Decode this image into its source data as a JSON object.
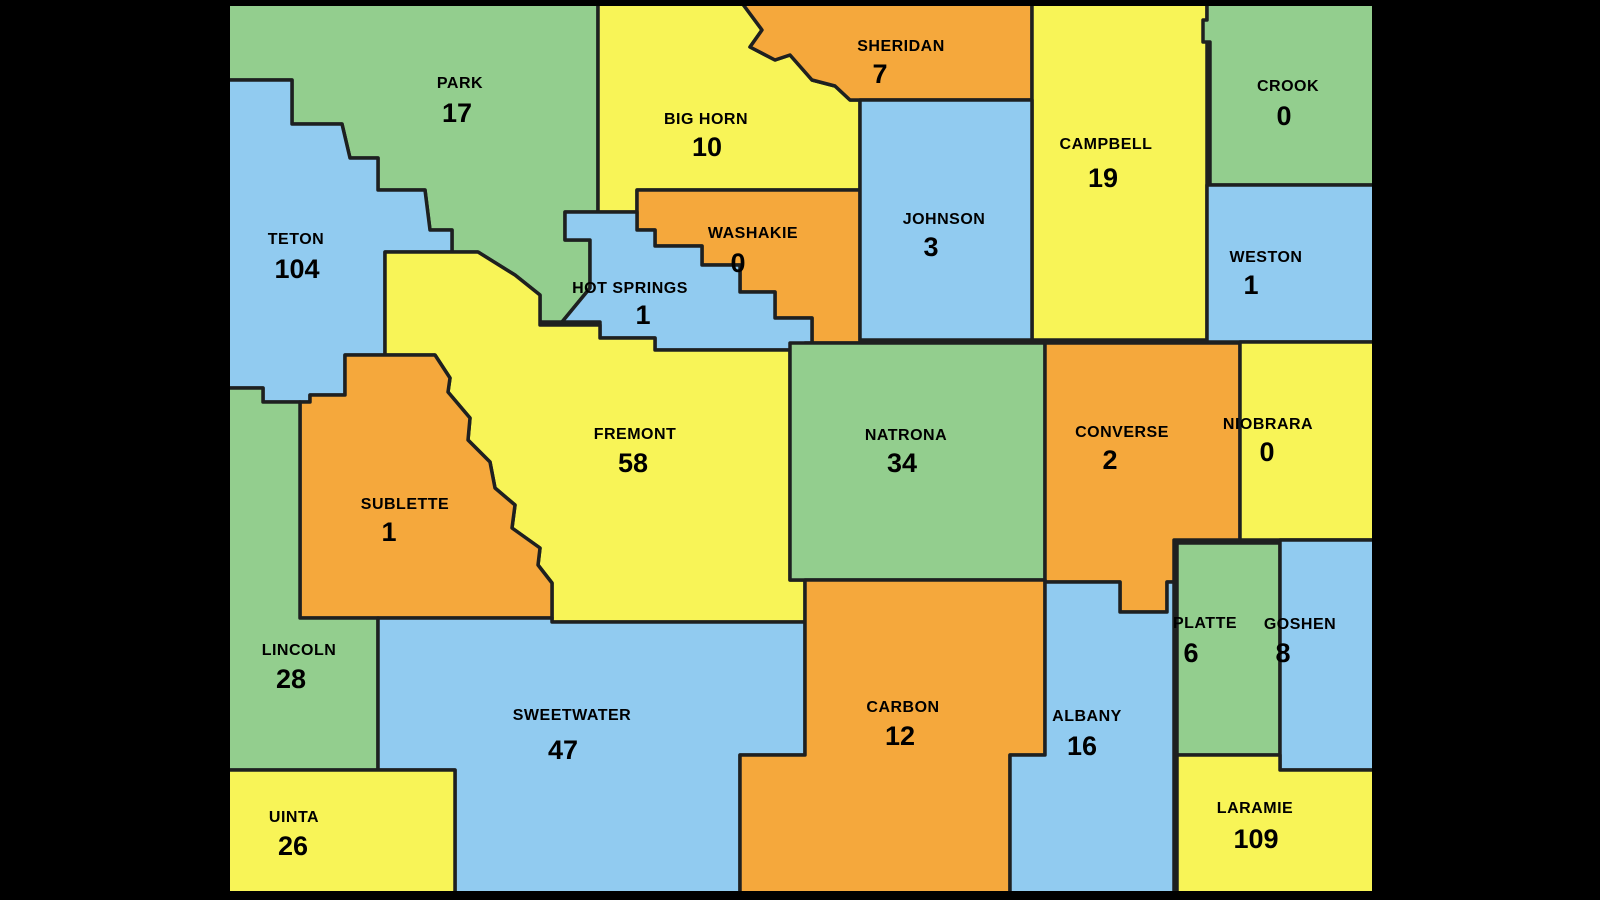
{
  "map": {
    "description": "Wyoming county map with per-county counts",
    "background_color": "#000000",
    "county_border_color": "#1e2020",
    "state_border_color": "#000000",
    "label_color": "#000000",
    "palette": {
      "green": "#93ce8e",
      "yellow": "#f8f457",
      "orange": "#f5a83c",
      "blue": "#91cbf0"
    },
    "state_bounds": {
      "x": 227,
      "y": 3,
      "width": 1148,
      "height": 891
    },
    "counties": [
      {
        "id": "park",
        "name": "PARK",
        "value": "17",
        "color": "green",
        "label": {
          "x": 460,
          "y": 88
        },
        "value_pos": {
          "x": 457,
          "y": 122
        },
        "points": "227,3 598,3 598,212 565,212 565,240 590,240 590,288 562,322 540,322 540,295 515,275 478,252 452,252 452,230 430,230 425,190 378,190 378,158 350,158 342,124 292,124 292,80 227,80"
      },
      {
        "id": "big-horn",
        "name": "BIG HORN",
        "value": "10",
        "color": "yellow",
        "label": {
          "x": 706,
          "y": 124
        },
        "value_pos": {
          "x": 707,
          "y": 156
        },
        "points": "598,3 742,3 762,30 750,47 775,60 790,55 812,80 835,86 850,100 860,100 860,190 637,190 637,212 598,212"
      },
      {
        "id": "sheridan",
        "name": "SHERIDAN",
        "value": "7",
        "color": "orange",
        "label": {
          "x": 901,
          "y": 51
        },
        "value_pos": {
          "x": 880,
          "y": 83
        },
        "points": "742,3 1032,3 1032,100 850,100 835,86 812,80 790,55 775,60 750,47 762,30"
      },
      {
        "id": "campbell",
        "name": "CAMPBELL",
        "value": "19",
        "color": "yellow",
        "label": {
          "x": 1106,
          "y": 149
        },
        "value_pos": {
          "x": 1103,
          "y": 187
        },
        "points": "1032,3 1207,3 1207,340 1032,340"
      },
      {
        "id": "crook",
        "name": "CROOK",
        "value": "0",
        "color": "green",
        "label": {
          "x": 1288,
          "y": 91
        },
        "value_pos": {
          "x": 1284,
          "y": 125
        },
        "points": "1207,3 1374,3 1374,185 1210,185 1210,42 1203,42 1203,20 1207,20"
      },
      {
        "id": "teton",
        "name": "TETON",
        "value": "104",
        "color": "blue",
        "label": {
          "x": 296,
          "y": 244
        },
        "value_pos": {
          "x": 297,
          "y": 278
        },
        "points": "227,80 292,80 292,124 342,124 350,158 378,158 378,190 425,190 430,230 452,230 452,252 385,252 385,355 345,355 345,395 310,395 310,402 263,402 263,388 227,388"
      },
      {
        "id": "washakie",
        "name": "WASHAKIE",
        "value": "0",
        "color": "orange",
        "label": {
          "x": 753,
          "y": 238
        },
        "value_pos": {
          "x": 738,
          "y": 272
        },
        "points": "637,190 860,190 860,343 812,343 812,318 775,318 775,292 740,292 740,265 702,265 702,246 655,246 655,230 637,230"
      },
      {
        "id": "johnson",
        "name": "JOHNSON",
        "value": "3",
        "color": "blue",
        "label": {
          "x": 944,
          "y": 224
        },
        "value_pos": {
          "x": 931,
          "y": 256
        },
        "points": "860,100 1032,100 1032,340 860,340"
      },
      {
        "id": "weston",
        "name": "WESTON",
        "value": "1",
        "color": "blue",
        "label": {
          "x": 1266,
          "y": 262
        },
        "value_pos": {
          "x": 1251,
          "y": 294
        },
        "points": "1207,185 1374,185 1374,342 1207,342"
      },
      {
        "id": "hot-springs",
        "name": "HOT SPRINGS",
        "value": "1",
        "color": "blue",
        "label": {
          "x": 630,
          "y": 293
        },
        "value_pos": {
          "x": 643,
          "y": 324
        },
        "points": "598,212 637,212 637,230 655,230 655,246 702,246 702,265 740,265 740,292 775,292 775,318 812,318 812,343 805,343 805,350 655,350 655,338 600,338 600,322 562,322 590,288 590,240 565,240 565,212"
      },
      {
        "id": "fremont",
        "name": "FREMONT",
        "value": "58",
        "color": "yellow",
        "label": {
          "x": 635,
          "y": 439
        },
        "value_pos": {
          "x": 633,
          "y": 472
        },
        "points": "385,252 452,252 478,252 515,275 540,295 540,325 600,325 600,338 655,338 655,350 790,350 790,580 805,580 805,622 552,622 552,583 538,565 540,548 512,528 515,505 495,488 490,462 468,440 470,418 448,392 450,378 435,355 385,355"
      },
      {
        "id": "natrona",
        "name": "NATRONA",
        "value": "34",
        "color": "green",
        "label": {
          "x": 906,
          "y": 440
        },
        "value_pos": {
          "x": 902,
          "y": 472
        },
        "points": "790,343 1045,343 1045,580 790,580"
      },
      {
        "id": "converse",
        "name": "CONVERSE",
        "value": "2",
        "color": "orange",
        "label": {
          "x": 1122,
          "y": 437
        },
        "value_pos": {
          "x": 1110,
          "y": 469
        },
        "points": "1045,343 1240,343 1240,540 1174,540 1174,582 1167,582 1167,612 1120,612 1120,582 1045,582"
      },
      {
        "id": "niobrara",
        "name": "NIOBRARA",
        "value": "0",
        "color": "yellow",
        "label": {
          "x": 1268,
          "y": 429
        },
        "value_pos": {
          "x": 1267,
          "y": 461
        },
        "points": "1240,342 1374,342 1374,540 1240,540"
      },
      {
        "id": "sublette",
        "name": "SUBLETTE",
        "value": "1",
        "color": "orange",
        "label": {
          "x": 405,
          "y": 509
        },
        "value_pos": {
          "x": 389,
          "y": 541
        },
        "points": "300,402 310,402 310,395 345,395 345,355 435,355 450,378 448,392 470,418 468,440 490,462 495,488 515,505 512,528 540,548 538,565 552,583 552,618 300,618"
      },
      {
        "id": "lincoln",
        "name": "LINCOLN",
        "value": "28",
        "color": "green",
        "label": {
          "x": 299,
          "y": 655
        },
        "value_pos": {
          "x": 291,
          "y": 688
        },
        "points": "227,388 263,388 263,402 300,402 300,618 378,618 378,770 227,770"
      },
      {
        "id": "sweetwater",
        "name": "SWEETWATER",
        "value": "47",
        "color": "blue",
        "label": {
          "x": 572,
          "y": 720
        },
        "value_pos": {
          "x": 563,
          "y": 759
        },
        "points": "378,618 552,618 552,622 805,622 805,755 740,755 740,894 455,894 455,770 378,770"
      },
      {
        "id": "carbon",
        "name": "CARBON",
        "value": "12",
        "color": "orange",
        "label": {
          "x": 903,
          "y": 712
        },
        "value_pos": {
          "x": 900,
          "y": 745
        },
        "points": "805,580 1045,580 1045,755 1010,755 1010,894 740,894 740,755 805,755"
      },
      {
        "id": "albany",
        "name": "ALBANY",
        "value": "16",
        "color": "blue",
        "label": {
          "x": 1087,
          "y": 721
        },
        "value_pos": {
          "x": 1082,
          "y": 755
        },
        "points": "1045,582 1120,582 1120,612 1167,612 1167,582 1174,582 1174,894 1010,894 1010,755 1045,755"
      },
      {
        "id": "platte",
        "name": "PLATTE",
        "value": "6",
        "color": "green",
        "label": {
          "x": 1205,
          "y": 628
        },
        "value_pos": {
          "x": 1191,
          "y": 662
        },
        "points": "1177,543 1280,543 1280,755 1177,755"
      },
      {
        "id": "goshen",
        "name": "GOSHEN",
        "value": "8",
        "color": "blue",
        "label": {
          "x": 1300,
          "y": 629
        },
        "value_pos": {
          "x": 1283,
          "y": 662
        },
        "points": "1280,540 1374,540 1374,770 1280,770"
      },
      {
        "id": "uinta",
        "name": "UINTA",
        "value": "26",
        "color": "yellow",
        "label": {
          "x": 294,
          "y": 822
        },
        "value_pos": {
          "x": 293,
          "y": 855
        },
        "points": "227,770 455,770 455,894 227,894"
      },
      {
        "id": "laramie",
        "name": "LARAMIE",
        "value": "109",
        "color": "yellow",
        "label": {
          "x": 1255,
          "y": 813
        },
        "value_pos": {
          "x": 1256,
          "y": 848
        },
        "points": "1177,755 1280,755 1280,770 1374,770 1374,894 1177,894"
      }
    ]
  }
}
